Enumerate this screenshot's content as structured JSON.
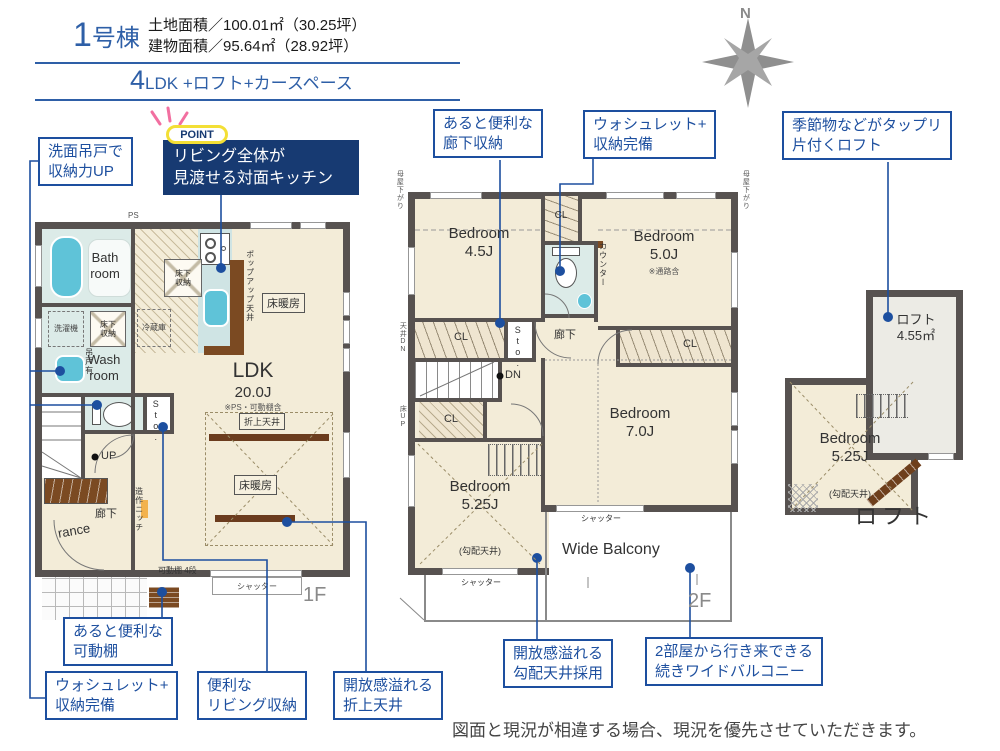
{
  "header": {
    "unit_num": "1",
    "unit_suffix": "号棟",
    "land": "土地面積／100.01㎡（30.25坪）",
    "building": "建物面積／95.64㎡（28.92坪）",
    "plan_num": "4",
    "plan_rest": "LDK +ロフト+カースペース"
  },
  "compass": {
    "n": "N"
  },
  "point": {
    "badge": "POINT",
    "text": "リビング全体が\n見渡せる対面キッチン"
  },
  "callouts": {
    "wash_cabinet": "洗面吊戸で\n収納力UP",
    "hall_storage": "あると便利な\n廊下収納",
    "washlet2f": "ウォシュレット+\n収納完備",
    "loft": "季節物などがタップリ\n片付くロフト",
    "shelf": "あると便利な\n可動棚",
    "washlet1f": "ウォシュレット+\n収納完備",
    "living_storage": "便利な\nリビング収納",
    "coffered": "開放感溢れる\n折上天井",
    "sloped": "開放感溢れる\n勾配天井採用",
    "balcony": "2部屋から行き来できる\n続きワイドバルコニー"
  },
  "f1": {
    "tag": "1F",
    "bath": "Bath\nroom",
    "wash": "Wash\nroom",
    "ldk": "LDK",
    "ldk_size": "20.0J",
    "ldk_note": "※PS・可動棚含",
    "hall": "廊下",
    "entrance": "rance",
    "ps": "PS",
    "laundry": "洗濯機",
    "underfloor": "床下\n収納",
    "fridge": "冷蔵庫",
    "hanging": "吊戸有",
    "popup": "ポップアップ天井",
    "heating": "床暖房",
    "coffered": "折上天井",
    "up": "UP",
    "sto": "Sto.",
    "niche": "造作ニッチ",
    "shelf": "可動棚 4段",
    "shutter": "シャッター"
  },
  "f2": {
    "tag": "2F",
    "bed45": "Bedroom\n4.5J",
    "bed50": "Bedroom\n5.0J",
    "bed50_note": "※通路含",
    "bed70": "Bedroom\n7.0J",
    "bed525": "Bedroom\n5.25J",
    "sloped": "(勾配天井)",
    "cl": "CL",
    "sto": "Sto.",
    "hall": "廊下",
    "counter": "カウンター",
    "dn": "DN",
    "ceil_dn": "天井DN",
    "floor_up": "床UP",
    "moya": "母屋下がり",
    "shutter": "シャッター",
    "balcony": "Wide Balcony"
  },
  "loft": {
    "tag": "ロフト",
    "room": "ロフト\n4.55㎡",
    "bed": "Bedroom\n5.25J",
    "sloped": "(勾配天井)"
  },
  "disclaimer": "図面と現況が相違する場合、現況を優先させていただきます。",
  "colors": {
    "accent": "#1d4f9f",
    "navy": "#173a72",
    "wall": "#575250",
    "floor": "#f3ecd8",
    "aqua": "#5fc3d8",
    "yellow": "#f3df35",
    "pink": "#f26fa0"
  }
}
